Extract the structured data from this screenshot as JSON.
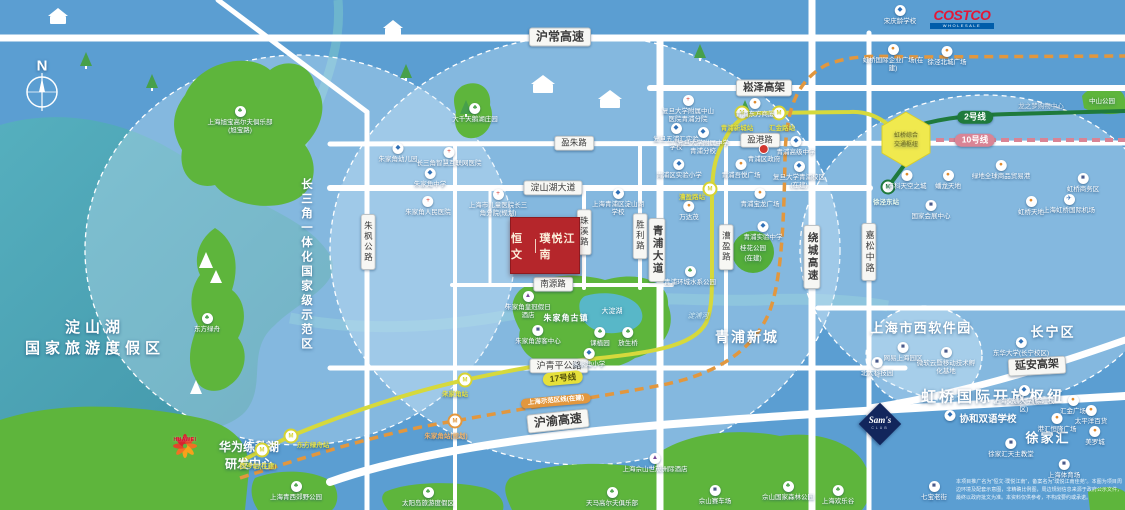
{
  "title": "恒文·璞悦江南 区位示意图",
  "compass": {
    "label": "N"
  },
  "project": {
    "brand": "恒文",
    "name": "璞悦江南"
  },
  "logos": {
    "costco": {
      "text": "COSTCO",
      "sub": "WHOLESALE"
    },
    "huawei": {
      "text": "HUAWEI"
    },
    "sams": {
      "text": "Sam's",
      "sub": "CLUB"
    }
  },
  "disclaimer": {
    "text": "本项目推广名为“恒文·璞悦江南”，备案名为“璞悦江南佳苑”。本图为项目周边环境及配套示意图，非精确比例图，周边规划信息来源于政府公示文件，最终以政府批文为准。本资料仅供参考，不构成要约或承诺。"
  },
  "zone_labels": [
    {
      "id": "compass-n",
      "text": "N",
      "x": 42,
      "y": 66,
      "s": 15,
      "b": 1
    },
    {
      "id": "dianshan-lake",
      "lines": [
        "淀山湖",
        "国家旅游度假区"
      ],
      "x": 95,
      "y": 337,
      "s": 15,
      "ls": 5,
      "b": 1
    },
    {
      "id": "yangtze-demo-zone",
      "text": "长三角一体化国家级示范区",
      "x": 306,
      "y": 265,
      "s": 11.5,
      "ls": 3,
      "b": 1,
      "vert": 1
    },
    {
      "id": "qingpu-new-city",
      "text": "青浦新城",
      "x": 747,
      "y": 337,
      "s": 14,
      "ls": 2,
      "b": 1
    },
    {
      "id": "hongqiao-hub",
      "text": "虹桥国际开放枢纽",
      "x": 993,
      "y": 396,
      "s": 15,
      "ls": 3,
      "b": 1
    },
    {
      "id": "shixi-software-park",
      "text": "上海市西软件园",
      "x": 921,
      "y": 327,
      "s": 13,
      "ls": 1.5,
      "b": 1
    },
    {
      "id": "changning-district",
      "text": "长宁区",
      "x": 1053,
      "y": 331,
      "s": 13,
      "ls": 2,
      "b": 1
    },
    {
      "id": "xujiahui",
      "text": "徐家汇",
      "x": 1048,
      "y": 437,
      "s": 13,
      "ls": 2,
      "b": 1
    },
    {
      "id": "zhujiajiao-town",
      "text": "朱家角古镇",
      "x": 566,
      "y": 318,
      "s": 8,
      "ls": 1,
      "b": 1
    },
    {
      "id": "dadian-lake",
      "text": "大淀湖",
      "x": 612,
      "y": 311,
      "s": 7
    },
    {
      "id": "dianpu-river",
      "text": "淀浦河",
      "x": 698,
      "y": 316,
      "s": 7,
      "i": 1,
      "c": "#cfeaf4"
    },
    {
      "id": "huawei-campus",
      "lines": [
        "华为练秋湖",
        "研发中心"
      ],
      "x": 249,
      "y": 455,
      "s": 12,
      "b": 1
    },
    {
      "id": "zhongshan-park",
      "text": "中山公园",
      "x": 1102,
      "y": 100,
      "s": 6.5
    },
    {
      "id": "guihua-park",
      "lines": [
        "桂花公园",
        "(在建)"
      ],
      "x": 753,
      "y": 252,
      "s": 6.5
    },
    {
      "id": "hongqiao-hex",
      "lines": [
        "虹桥综合",
        "交通枢纽"
      ],
      "x": 906,
      "y": 139,
      "s": 6,
      "c": "#6e6a22"
    },
    {
      "id": "xiehe-school",
      "text": "协和双语学校",
      "x": 988,
      "y": 418,
      "s": 9.5,
      "b": 1
    }
  ],
  "road_labels": [
    {
      "text": "沪常高速",
      "x": 560,
      "y": 37,
      "s": 12,
      "b": 1
    },
    {
      "text": "崧泽高架",
      "x": 764,
      "y": 88,
      "s": 10.5,
      "b": 1
    },
    {
      "text": "盈朱路",
      "x": 574,
      "y": 143,
      "s": 8.5
    },
    {
      "text": "盈港路",
      "x": 760,
      "y": 140,
      "s": 8.5
    },
    {
      "text": "淀山湖大道",
      "x": 553,
      "y": 188,
      "s": 9
    },
    {
      "text": "南源路",
      "x": 553,
      "y": 284,
      "s": 8.5
    },
    {
      "text": "沪青平公路",
      "x": 559,
      "y": 366,
      "s": 9
    },
    {
      "text": "沪渝高速",
      "x": 558,
      "y": 421,
      "s": 12,
      "b": 1,
      "rot": -6
    },
    {
      "text": "延安高架",
      "x": 1037,
      "y": 366,
      "s": 11,
      "b": 1,
      "rot": -3
    },
    {
      "text": "朱枫公路",
      "x": 368,
      "y": 242,
      "s": 8.5,
      "vert": 1
    },
    {
      "text": "珠溪路",
      "x": 584,
      "y": 232,
      "s": 8.5,
      "vert": 1
    },
    {
      "text": "胜利路",
      "x": 640,
      "y": 236,
      "s": 8.5,
      "vert": 1
    },
    {
      "text": "青浦大道",
      "x": 657,
      "y": 250,
      "s": 10.5,
      "b": 1,
      "vert": 1
    },
    {
      "text": "漕盈路",
      "x": 726,
      "y": 247,
      "s": 8.5,
      "vert": 1
    },
    {
      "text": "绕城高速",
      "x": 812,
      "y": 257,
      "s": 10.5,
      "b": 1,
      "vert": 1
    },
    {
      "text": "嘉松中路",
      "x": 869,
      "y": 252,
      "s": 9,
      "vert": 1
    }
  ],
  "metro": {
    "pills": [
      {
        "name": "17号线",
        "x": 563,
        "y": 378,
        "rot": -5,
        "bg": "#e6e03a",
        "fg": "#55520e",
        "s": 8.5
      },
      {
        "name": "2号线",
        "x": 975,
        "y": 117,
        "rot": 0,
        "bg": "#1f7a3c",
        "fg": "#ffffff",
        "s": 8.5
      },
      {
        "name": "10号线",
        "x": 975,
        "y": 140,
        "rot": 0,
        "bg": "#d98495",
        "fg": "#ffffff",
        "s": 8.5
      },
      {
        "name": "上海示范区线(在建)",
        "x": 556,
        "y": 401,
        "rot": -5,
        "bg": "#e2973e",
        "fg": "#ffffff",
        "s": 6.5
      }
    ],
    "stations": [
      {
        "label": "西岑站(在建)",
        "x": 262,
        "y": 450,
        "ring": "#d6d333",
        "lx": 258,
        "ly": 465,
        "c": "#e3df45"
      },
      {
        "label": "东方绿舟站",
        "x": 291,
        "y": 436,
        "ring": "#d6d333",
        "lx": 313,
        "ly": 444,
        "c": "#e3df45"
      },
      {
        "label": "朱家角站",
        "x": 465,
        "y": 380,
        "ring": "#d6d333",
        "lx": 455,
        "ly": 393,
        "c": "#e3df45"
      },
      {
        "label": "漕盈路站",
        "x": 710,
        "y": 189,
        "ring": "#d6d333",
        "lx": 692,
        "ly": 196,
        "c": "#e3df45"
      },
      {
        "label": "青浦新城站",
        "x": 742,
        "y": 113,
        "ring": "#d6d333",
        "lx": 737,
        "ly": 127,
        "c": "#e3df45"
      },
      {
        "label": "汇金路站",
        "x": 779,
        "y": 113,
        "ring": "#d6d333",
        "lx": 782,
        "ly": 127,
        "c": "#e3df45"
      },
      {
        "label": "朱家角站(规划)",
        "x": 455,
        "y": 421,
        "ring": "#e2973e",
        "lx": 446,
        "ly": 435,
        "c": "#f0b26a"
      },
      {
        "label": "徐泾东站",
        "x": 888,
        "y": 187,
        "ring": "#1f7a3c",
        "lx": 886,
        "ly": 201,
        "c": "#eafbef"
      }
    ]
  },
  "pois": [
    {
      "t": "golf",
      "label": "上海旭宝高尔夫俱乐部(旭宝路)",
      "x": 240,
      "y": 106,
      "w": 66
    },
    {
      "t": "park",
      "label": "东方绿舟",
      "x": 207,
      "y": 313,
      "w": 40
    },
    {
      "t": "park",
      "label": "上海青西郊野公园",
      "x": 296,
      "y": 481,
      "w": 62
    },
    {
      "t": "park",
      "label": "大千天鹅湖庄园",
      "x": 475,
      "y": 103,
      "w": 46
    },
    {
      "t": "school",
      "label": "朱家角幼儿园",
      "x": 398,
      "y": 143,
      "w": 50
    },
    {
      "t": "hospital",
      "label": "长三角智慧互联网医院",
      "x": 449,
      "y": 147,
      "w": 70
    },
    {
      "t": "school",
      "label": "朱家角中学",
      "x": 430,
      "y": 168,
      "w": 60
    },
    {
      "t": "hospital",
      "label": "朱家角人民医院",
      "x": 428,
      "y": 196,
      "w": 54
    },
    {
      "t": "hospital",
      "label": "上海市儿童医院长三角分院(规划)",
      "x": 498,
      "y": 189,
      "w": 62
    },
    {
      "t": "school",
      "label": "上海青浦区淀山湖学校",
      "x": 618,
      "y": 188,
      "w": 58
    },
    {
      "t": "landmark",
      "label": "朱家角游客中心",
      "x": 538,
      "y": 325,
      "w": 48
    },
    {
      "t": "park",
      "label": "课植园",
      "x": 600,
      "y": 327,
      "w": 36
    },
    {
      "t": "park",
      "label": "放生桥",
      "x": 628,
      "y": 327,
      "w": 36
    },
    {
      "t": "school",
      "label": "朱家角小学",
      "x": 589,
      "y": 348,
      "w": 56
    },
    {
      "t": "hotel",
      "label": "朱家角皇冠假日酒店",
      "x": 528,
      "y": 291,
      "w": 50
    },
    {
      "t": "hospital",
      "label": "复旦大学附属中山医院青浦分院",
      "x": 688,
      "y": 95,
      "w": 58
    },
    {
      "t": "mall",
      "label": "青浦东方商厦",
      "x": 755,
      "y": 98,
      "w": 56
    },
    {
      "t": "school",
      "label": "复旦五浦汇实验学校",
      "x": 676,
      "y": 123,
      "w": 48
    },
    {
      "t": "school",
      "label": "复旦大学附属中学青浦分校",
      "x": 703,
      "y": 127,
      "w": 52
    },
    {
      "t": "gov",
      "label": "青浦区政府",
      "x": 764,
      "y": 144,
      "w": 50
    },
    {
      "t": "school",
      "label": "青浦高级中学",
      "x": 796,
      "y": 136,
      "w": 52
    },
    {
      "t": "school",
      "label": "青浦区实验小学",
      "x": 679,
      "y": 159,
      "w": 56
    },
    {
      "t": "mall",
      "label": "青浦吾悦广场",
      "x": 741,
      "y": 159,
      "w": 54
    },
    {
      "t": "school",
      "label": "复旦大学青浦校区(在建)",
      "x": 799,
      "y": 161,
      "w": 54
    },
    {
      "t": "mall",
      "label": "万达茂",
      "x": 689,
      "y": 201,
      "w": 40
    },
    {
      "t": "mall",
      "label": "青浦宝龙广场",
      "x": 760,
      "y": 188,
      "w": 54
    },
    {
      "t": "school",
      "label": "青浦实验中学",
      "x": 763,
      "y": 221,
      "w": 54
    },
    {
      "t": "park",
      "label": "青浦环城水系公园",
      "x": 690,
      "y": 266,
      "w": 60
    },
    {
      "t": "school",
      "label": "宋庆龄学校",
      "x": 900,
      "y": 5,
      "w": 56
    },
    {
      "t": "mall",
      "label": "虹桥国际企业广场(在建)",
      "x": 893,
      "y": 44,
      "w": 62
    },
    {
      "t": "mall",
      "label": "徐泾北城广场",
      "x": 947,
      "y": 46,
      "w": 54
    },
    {
      "t": "mall",
      "label": "万科天空之城",
      "x": 907,
      "y": 170,
      "w": 52
    },
    {
      "t": "mall",
      "label": "蟠龙天地",
      "x": 948,
      "y": 170,
      "w": 40
    },
    {
      "t": "landmark",
      "label": "国家会展中心",
      "x": 931,
      "y": 200,
      "w": 58
    },
    {
      "t": "mall",
      "label": "绿地全球商品贸易港",
      "x": 1001,
      "y": 160,
      "w": 66
    },
    {
      "t": "mall",
      "label": "虹桥天地",
      "x": 1031,
      "y": 196,
      "w": 40
    },
    {
      "t": "transport",
      "label": "上海虹桥国际机场",
      "x": 1069,
      "y": 194,
      "w": 60
    },
    {
      "t": "landmark",
      "label": "虹桥商务区",
      "x": 1083,
      "y": 173,
      "w": 46
    },
    {
      "t": "note",
      "label": "龙之梦购物中心",
      "x": 1041,
      "y": 101,
      "w": 58
    },
    {
      "t": "landmark",
      "label": "网易上海园区",
      "x": 903,
      "y": 342,
      "w": 50
    },
    {
      "t": "landmark",
      "label": "微软云暨移动技术孵化基地",
      "x": 946,
      "y": 347,
      "w": 62
    },
    {
      "t": "landmark",
      "label": "北大科技园",
      "x": 877,
      "y": 357,
      "w": 46
    },
    {
      "t": "school",
      "label": "东华大学(长宁校区)",
      "x": 1021,
      "y": 337,
      "w": 58
    },
    {
      "t": "school",
      "label": "上海交通大学(徐汇校区)",
      "x": 1024,
      "y": 385,
      "w": 62
    },
    {
      "t": "mall",
      "label": "汇金广场",
      "x": 1073,
      "y": 395,
      "w": 40
    },
    {
      "t": "mall",
      "label": "港汇恒隆广场",
      "x": 1057,
      "y": 413,
      "w": 54
    },
    {
      "t": "mall",
      "label": "太平洋百货",
      "x": 1091,
      "y": 405,
      "w": 46
    },
    {
      "t": "mall",
      "label": "美罗城",
      "x": 1095,
      "y": 426,
      "w": 36
    },
    {
      "t": "landmark",
      "label": "徐家汇天主教堂",
      "x": 1011,
      "y": 438,
      "w": 58
    },
    {
      "t": "landmark",
      "label": "上海体育场",
      "x": 1064,
      "y": 459,
      "w": 48
    },
    {
      "t": "landmark",
      "label": "七宝老街",
      "x": 934,
      "y": 481,
      "w": 40
    },
    {
      "t": "school",
      "label": "",
      "x": 950,
      "y": 410,
      "w": 10
    },
    {
      "t": "park",
      "label": "太阳岛旅游度假区",
      "x": 428,
      "y": 487,
      "w": 66
    },
    {
      "t": "golf",
      "label": "天马高尔夫俱乐部",
      "x": 612,
      "y": 487,
      "w": 62
    },
    {
      "t": "landmark",
      "label": "佘山赛车场",
      "x": 715,
      "y": 485,
      "w": 50
    },
    {
      "t": "park",
      "label": "佘山国家森林公园",
      "x": 788,
      "y": 481,
      "w": 62
    },
    {
      "t": "park",
      "label": "上海欢乐谷",
      "x": 838,
      "y": 485,
      "w": 48
    },
    {
      "t": "hotel",
      "label": "上海佘山世茂洲际酒店",
      "x": 655,
      "y": 453,
      "w": 68
    }
  ],
  "icon_glyphs": {
    "school": {
      "g": "◆",
      "c": "#2f6fb5"
    },
    "hospital": {
      "g": "+",
      "c": "#d2372f"
    },
    "mall": {
      "g": "●",
      "c": "#e08a2d"
    },
    "park": {
      "g": "♣",
      "c": "#3f9d3f"
    },
    "golf": {
      "g": "♣",
      "c": "#3f9d3f"
    },
    "landmark": {
      "g": "■",
      "c": "#4a5a8a"
    },
    "hotel": {
      "g": "▲",
      "c": "#7a4a9a"
    },
    "transport": {
      "g": "✈",
      "c": "#2f6fb5"
    },
    "gov": {
      "g": "",
      "c": "#d2372f"
    }
  }
}
